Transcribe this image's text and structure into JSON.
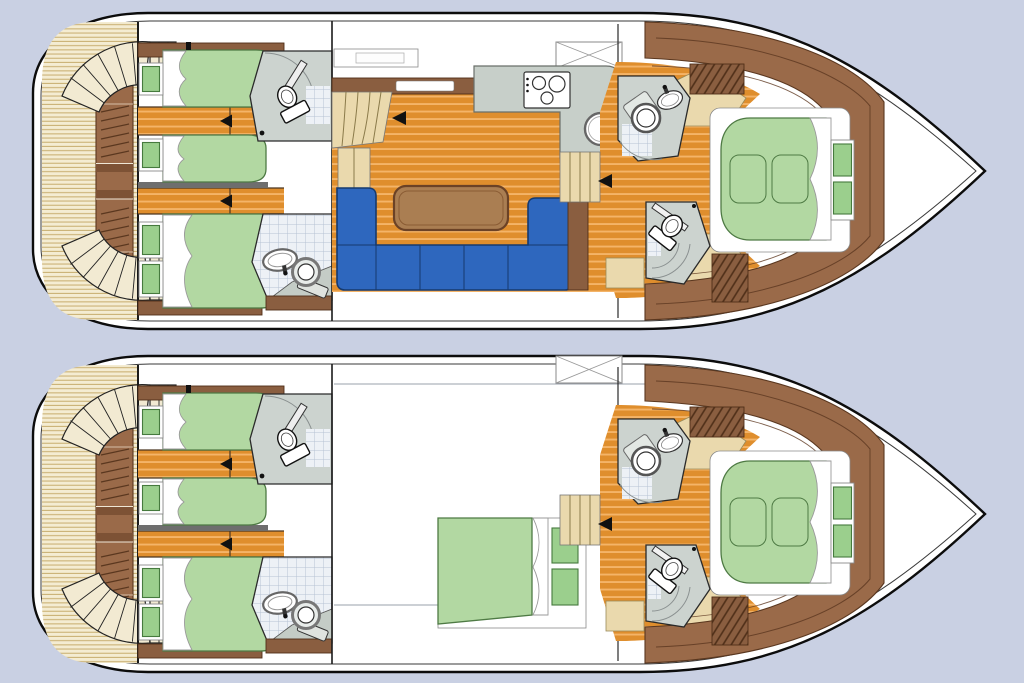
{
  "title": "motor-yacht-two-deck-floorplan",
  "decks": [
    {
      "id": "upper-deck",
      "features": [
        "aft-twin-cabin",
        "aft-double-cabin",
        "two-aft-bathrooms",
        "salon-u-sofa",
        "salon-table",
        "galley-stove-sink",
        "companionway-stairs",
        "bow-island-bed",
        "two-bow-bathrooms",
        "swim-platform-stairs"
      ]
    },
    {
      "id": "lower-deck",
      "features": [
        "aft-twin-cabin",
        "aft-double-cabin",
        "two-aft-bathrooms",
        "mid-double-cabin",
        "bow-island-bed",
        "two-bow-bathrooms",
        "swim-platform-stairs"
      ]
    }
  ],
  "icons": {
    "direction_arrow": "◀",
    "roof_hatch": "✕"
  },
  "colors": {
    "bg": "#c9d0e3",
    "line": "#0c0c0c",
    "inner-line": "#3a3a3a",
    "white": "#ffffff",
    "deck-cream": "#f4ecd2",
    "deck-stripe": "#cbb276",
    "wood-base": "#df8e2d",
    "wood-stripe": "#f4b468",
    "walnut": "#9a6a49",
    "walnut-dark": "#5a371f",
    "cabinet-brown": "#8a5e40",
    "cabinet-dark": "#4f2f18",
    "bed-green": "#b2d8a2",
    "bed-green-line": "#4e7a44",
    "cushion-green": "#9bcf8d",
    "sofa-blue": "#2e67be",
    "sofa-blue-dark": "#163a6e",
    "table-brown": "#aa7e52",
    "table-brown-dark": "#6b4226",
    "counter-gray": "#c7cfc9",
    "bath-gray": "#ccd3cf",
    "tile-bg": "#edf1f6",
    "tile-line": "#b7c3d4",
    "stair-tan": "#ead9ad",
    "stair-line": "#8a7a4a",
    "divider-gray": "#6e6e6e",
    "chine-gray": "#9aa0ab",
    "arrow-black": "#111111"
  }
}
